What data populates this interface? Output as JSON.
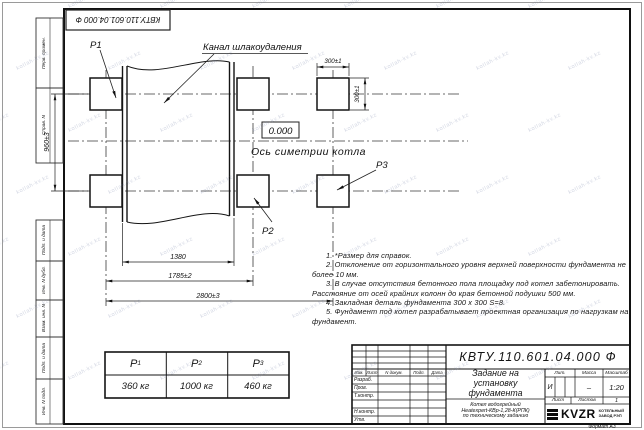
{
  "watermark": {
    "text": "kotlah-kv.kz"
  },
  "frame": {
    "stamp_doc_number": "КВТУ.110.601.04.000 Ф",
    "format_label": "Формат А3"
  },
  "margin": {
    "top_labels": [
      "Перв. примен.",
      "Справ. N"
    ],
    "bottom_labels": [
      "Подп. и дата",
      "Инв. N дубл.",
      "Взам. инв. N",
      "Подп. и дата",
      "Инв. N подл."
    ]
  },
  "drawing": {
    "p1_label": "P1",
    "p2_label": "P2",
    "p3_label": "P3",
    "channel_label": "Канал шлакоудаления",
    "level_value": "0.000",
    "axis_label": "Ось симетрии котла",
    "dim_960": "960±3",
    "dim_300_h": "300±1",
    "dim_300_v": "300±1",
    "dim_1380": "1380",
    "dim_1785": "1785±2",
    "dim_2800": "2800±3"
  },
  "notes": {
    "items": [
      "1. *Размер для справок.",
      "2. Отклонение от горизонтального уровня верхней поверхности фундамента не более 10 мм.",
      "3. В случае отсутствия бетонного пола площадку под котел забетонировать. Расстояние от осей крайних колонн до края бетонной подушки 500 мм.",
      "4. Закладная деталь фундамента  300 x 300  S=8.",
      "5. Фундамент под котел разрабатывает проектная организация по нагрузкам на фундамент."
    ]
  },
  "load_table": {
    "headers": [
      {
        "base": "P",
        "sub": "1"
      },
      {
        "base": "P",
        "sub": "2"
      },
      {
        "base": "P",
        "sub": "3"
      }
    ],
    "values": [
      "360 кг",
      "1000 кг",
      "460 кг"
    ]
  },
  "title_block": {
    "doc_number": "КВТУ.110.601.04.000  Ф",
    "title_lines": [
      "Задание на",
      "установку",
      "фундамента"
    ],
    "subtitle_lines": [
      "Котел водогрейный",
      "Heatexpert-КВр-1,28-К(РПК)",
      "по техническому заданию"
    ],
    "rev_headers": [
      "Изм.",
      "Лист",
      "N докум.",
      "Подп.",
      "Дата"
    ],
    "sig_labels": [
      "Разраб.",
      "Пров.",
      "Т.контр.",
      "",
      "Н.контр.",
      "Утв."
    ],
    "lit_header": "Лит.",
    "mass_header": "Масса",
    "scale_header": "Масштаб",
    "lit_value": "И",
    "mass_value": "–",
    "scale_value": "1:20",
    "sheet_label": "Лист",
    "sheets_label": "Листов",
    "sheets_value": "1",
    "logo_text": "KVZR",
    "company_lines": [
      "КОТЕЛЬНЫЙ",
      "ЗАВОД РЭП"
    ]
  }
}
